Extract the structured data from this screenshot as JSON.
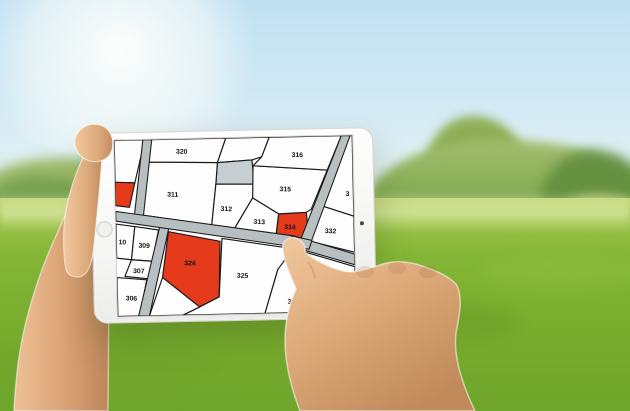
{
  "scene": {
    "sky_color": "#bfe0f1",
    "grass_color": "#7bae2e",
    "tree_color": "#7fa94e",
    "skin_color": "#d9a577",
    "tablet_body_color": "#f6f6f4"
  },
  "map": {
    "colors": {
      "background": "#fdfdfd",
      "road_fill": "#b8bfc1",
      "boundary": "#1b1b1b",
      "highlight": "#e63a1c",
      "reserved": "#c7ced1",
      "label": "#111111"
    },
    "selected_parcel_label": "314",
    "roads": [
      {
        "name": "left-road",
        "points": "58,0 76,0 54,172 36,168"
      },
      {
        "name": "lower-road",
        "points": "90,174 108,178 64,362 42,362"
      },
      {
        "name": "main-road",
        "points": "0,146 360,204 482,244 482,266 356,226 0,166"
      },
      {
        "name": "right-road",
        "points": "460,0 478,0 394,218 374,210"
      },
      {
        "name": "junction",
        "points": "356,204 396,214 390,232 350,226"
      }
    ],
    "parcels": [
      {
        "label": "",
        "points": "0,0 62,0 40,88 0,86",
        "type": "normal"
      },
      {
        "label": "",
        "points": "0,86 40,88 28,138 0,134",
        "type": "highlight"
      },
      {
        "label": "320",
        "x": 136,
        "y": 30,
        "points": "74,0 226,0 208,50 64,46",
        "type": "normal"
      },
      {
        "label": "",
        "points": "226,0 314,0 298,40 278,46 208,50",
        "type": "normal"
      },
      {
        "label": "",
        "points": "208,50 278,46 282,96 204,94",
        "type": "reserved"
      },
      {
        "label": "311",
        "x": 116,
        "y": 118,
        "points": "64,46 208,50 204,94 194,178 50,154",
        "type": "normal"
      },
      {
        "label": "312",
        "x": 224,
        "y": 150,
        "points": "204,94 282,96 278,124 240,186 194,178",
        "type": "normal"
      },
      {
        "label": "313",
        "x": 290,
        "y": 178,
        "points": "278,124 330,158 324,200 240,186",
        "type": "normal"
      },
      {
        "label": "314",
        "x": 352,
        "y": 190,
        "points": "330,158 386,156 390,212 324,200",
        "type": "highlight"
      },
      {
        "label": "315",
        "x": 344,
        "y": 112,
        "points": "280,58 430,70 396,150 386,156 330,158 278,124",
        "type": "normal"
      },
      {
        "label": "316",
        "x": 370,
        "y": 42,
        "points": "314,0 460,0 430,70 280,58 298,40",
        "type": "normal"
      },
      {
        "label": "3",
        "x": 470,
        "y": 124,
        "points": "478,0 482,0 482,166 408,140",
        "type": "normal"
      },
      {
        "label": "332",
        "x": 434,
        "y": 200,
        "points": "408,140 482,166 482,240 394,216",
        "type": "normal"
      },
      {
        "label": "10",
        "x": 12,
        "y": 214,
        "points": "0,172 38,178 30,246 0,242",
        "type": "normal"
      },
      {
        "label": "309",
        "x": 56,
        "y": 222,
        "points": "38,178 86,186 72,250 30,246",
        "type": "normal"
      },
      {
        "label": "307",
        "x": 44,
        "y": 274,
        "points": "30,246 72,250 64,286 16,280",
        "type": "normal"
      },
      {
        "label": "306",
        "x": 28,
        "y": 330,
        "points": "0,282 60,288 44,362 0,362",
        "type": "normal"
      },
      {
        "label": "324",
        "x": 148,
        "y": 260,
        "points": "106,190 210,212 206,326 166,346 92,284",
        "type": "highlight"
      },
      {
        "label": "325",
        "x": 254,
        "y": 288,
        "points": "214,206 368,232 326,272 298,362 132,362 166,346 206,326",
        "type": "normal"
      },
      {
        "label": "",
        "points": "92,284 166,346 132,362 64,362",
        "type": "normal"
      },
      {
        "label": "328",
        "x": 356,
        "y": 344,
        "points": "358,230 482,270 482,362 298,362 326,272",
        "type": "normal"
      }
    ]
  }
}
